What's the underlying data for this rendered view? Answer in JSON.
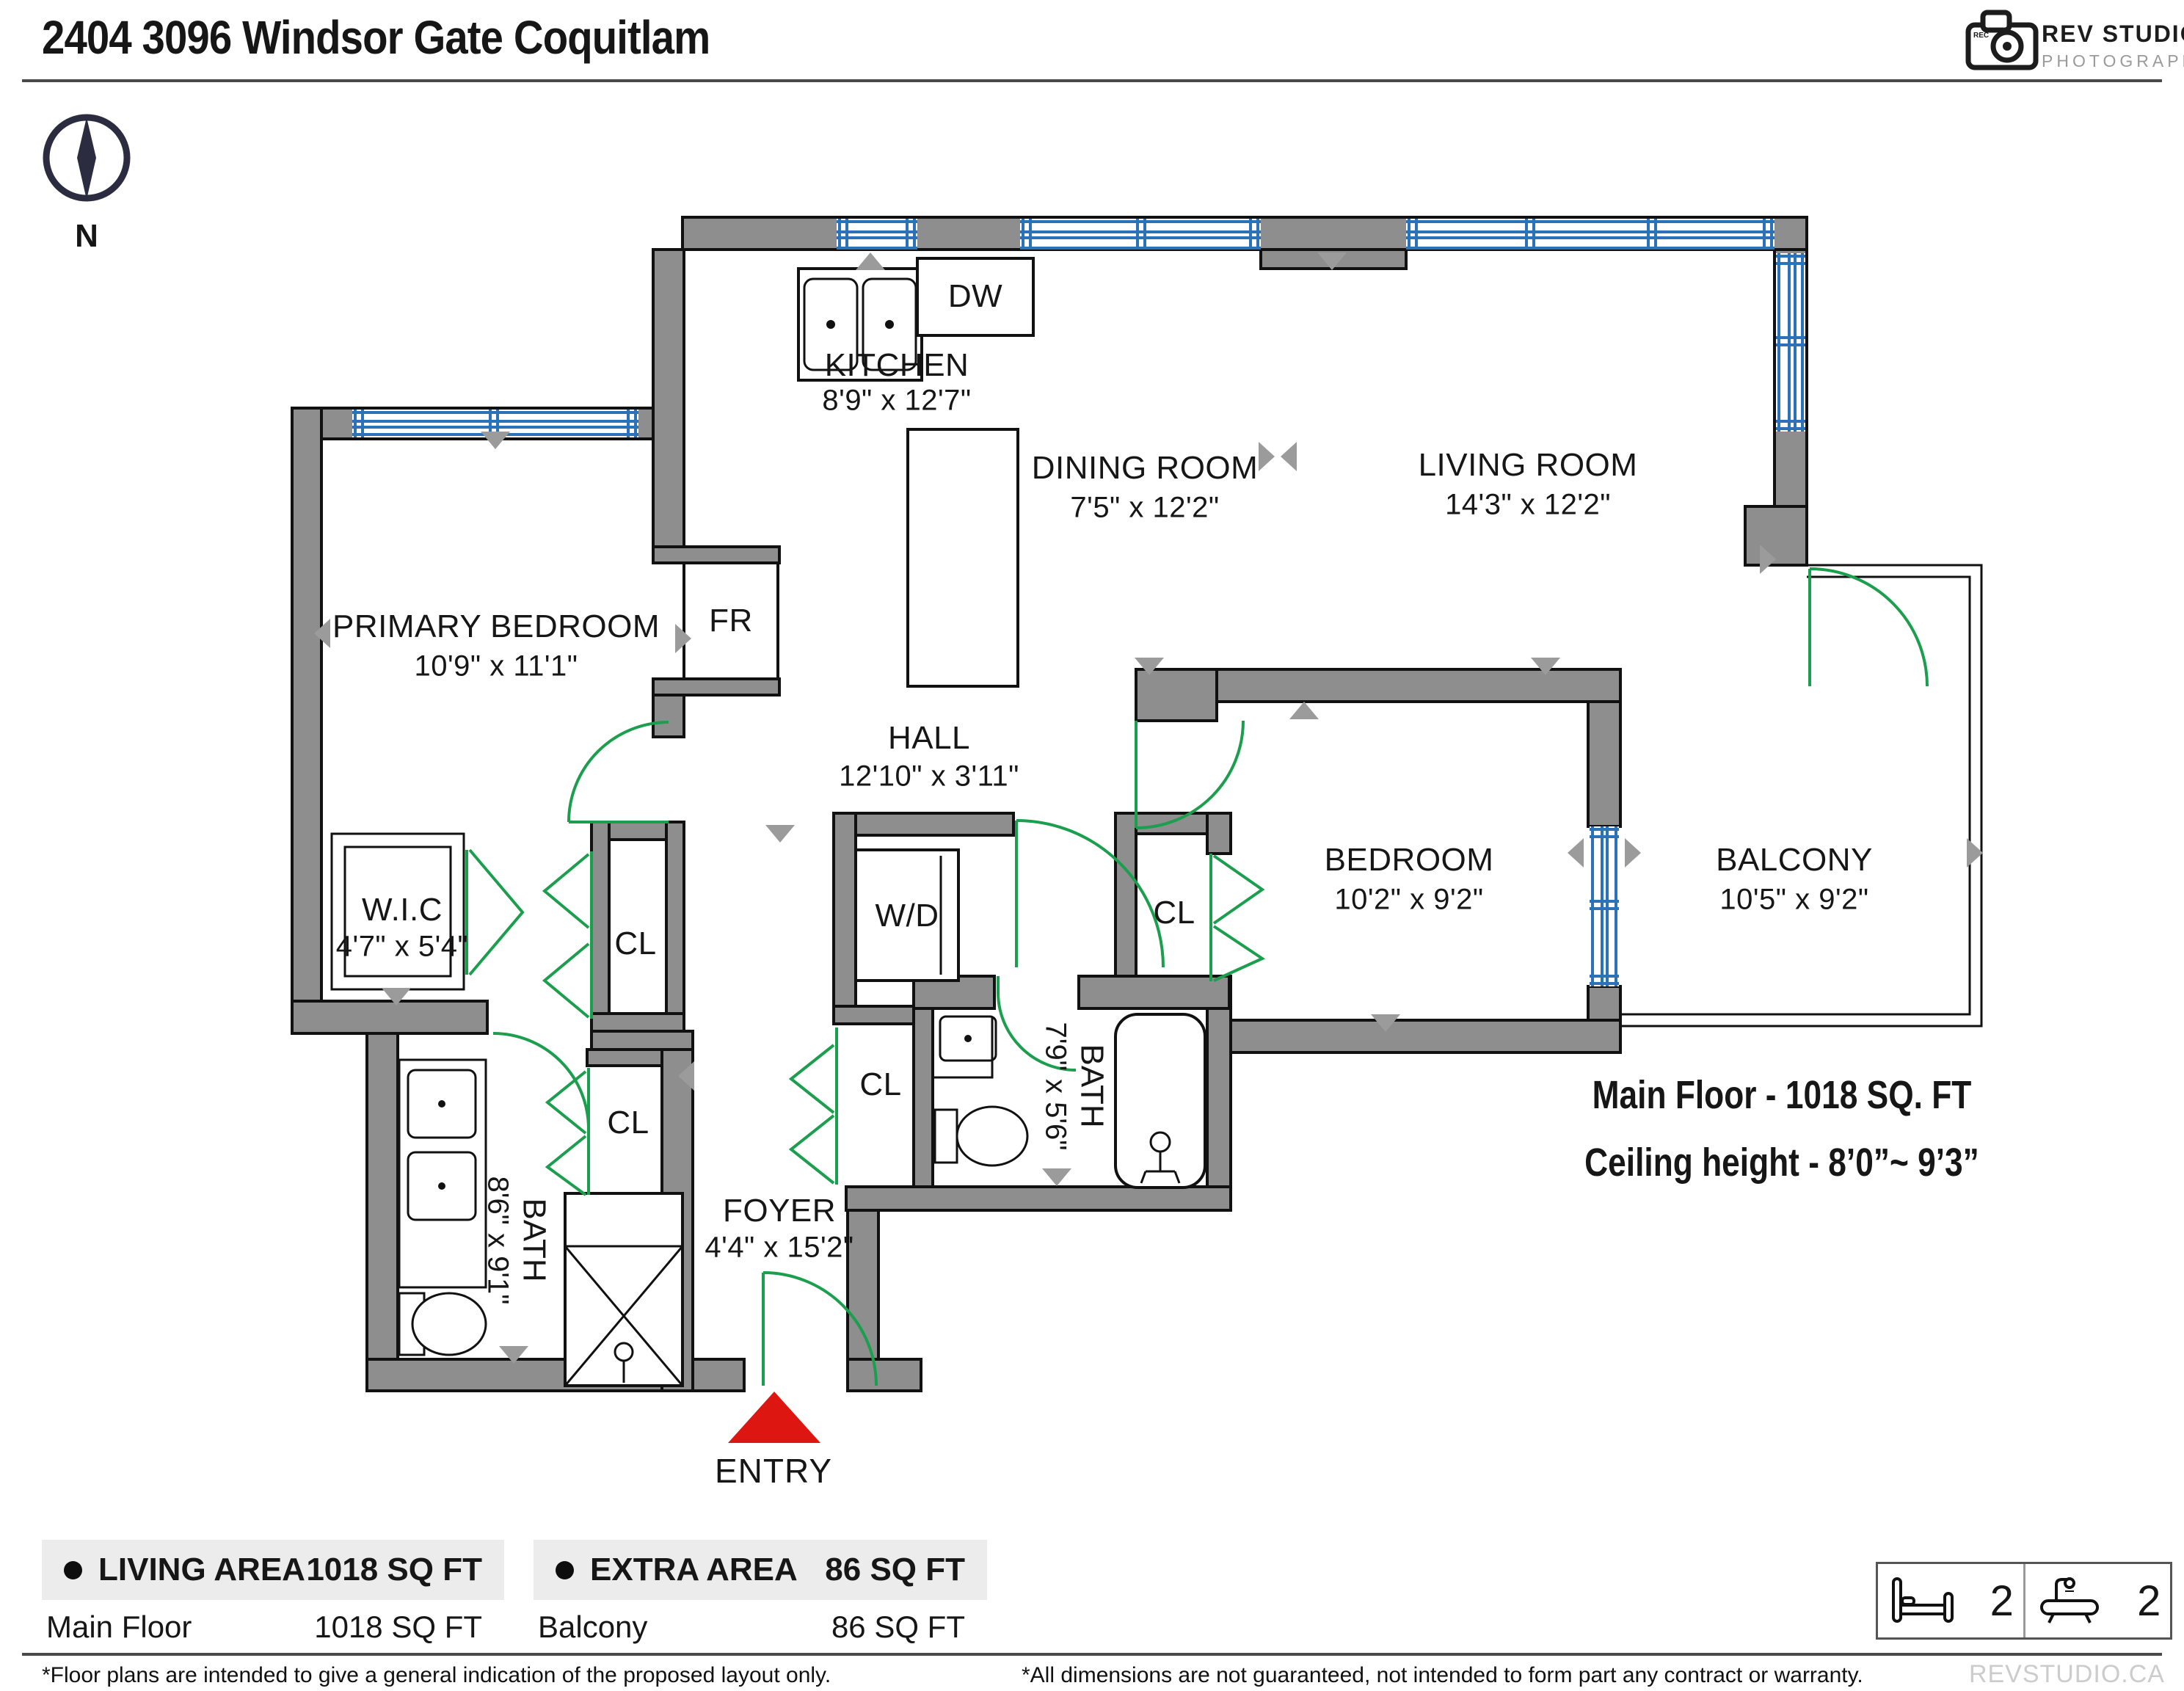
{
  "header": {
    "title": "2404 3096 Windsor Gate Coquitlam"
  },
  "logo": {
    "brand": "REV STUDIO",
    "subtitle": "PHOTOGRAPHY",
    "rec": "REC"
  },
  "compass": {
    "north_label": "N"
  },
  "floorplan": {
    "rooms": {
      "kitchen": {
        "name": "KITCHEN",
        "dims": "8'9\" x 12'7\""
      },
      "dining_room": {
        "name": "DINING ROOM",
        "dims": "7'5\" x 12'2\""
      },
      "living_room": {
        "name": "LIVING ROOM",
        "dims": "14'3\" x 12'2\""
      },
      "primary_bedroom": {
        "name": "PRIMARY BEDROOM",
        "dims": "10'9\" x 11'1\""
      },
      "hall": {
        "name": "HALL",
        "dims": "12'10\" x 3'11\""
      },
      "wic": {
        "name": "W.I.C",
        "dims": "4'7\" x 5'4\""
      },
      "bedroom": {
        "name": "BEDROOM",
        "dims": "10'2\" x 9'2\""
      },
      "balcony": {
        "name": "BALCONY",
        "dims": "10'5\" x 9'2\""
      },
      "bath_primary": {
        "name": "BATH",
        "dims": "8'6\" x 9'1\""
      },
      "bath_main": {
        "name": "BATH",
        "dims": "7'9\" x 5'6\""
      },
      "foyer": {
        "name": "FOYER",
        "dims": "4'4\" x 15'2\""
      }
    },
    "fixtures": {
      "fridge": "FR",
      "dishwasher": "DW",
      "washer_dryer": "W/D",
      "closet": "CL"
    },
    "entry_label": "ENTRY",
    "area_note": "Main Floor - 1018 SQ. FT",
    "ceiling_note": "Ceiling height - 8’0”~ 9’3”"
  },
  "tables": {
    "living_area": {
      "header": "LIVING AREA",
      "header_value": "1018 SQ FT",
      "rows": [
        {
          "label": "Main Floor",
          "value": "1018 SQ FT"
        }
      ]
    },
    "extra_area": {
      "header": "EXTRA AREA",
      "header_value": "86 SQ FT",
      "rows": [
        {
          "label": "Balcony",
          "value": "86 SQ FT"
        }
      ]
    }
  },
  "stats": {
    "bedrooms": "2",
    "bathrooms": "2"
  },
  "footer": {
    "disclaimer_left": "*Floor plans are intended to give a general indication of the proposed layout only.",
    "disclaimer_right": "*All dimensions are not guaranteed, not intended to form part any contract or warranty.",
    "brand": "REVSTUDIO.CA"
  },
  "colors": {
    "wall": "#8e8e8e",
    "window": "#2b72b8",
    "door": "#1b9e4d",
    "entry": "#dd1612"
  }
}
